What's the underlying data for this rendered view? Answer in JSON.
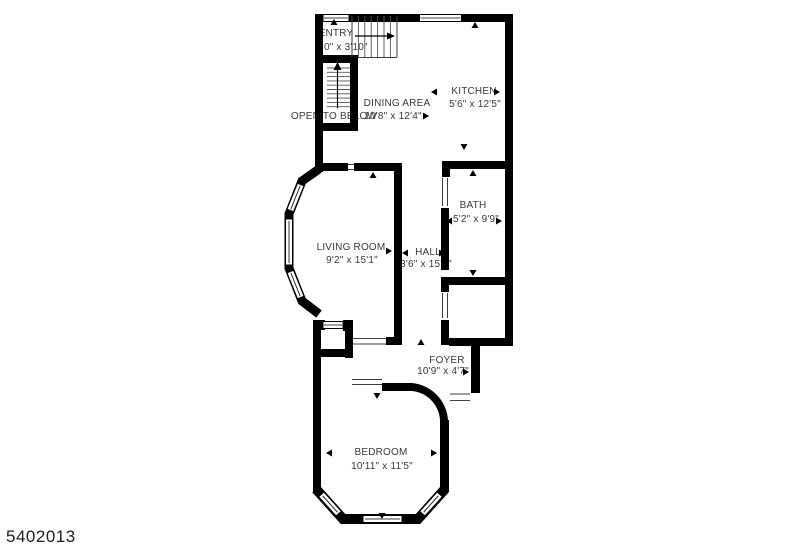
{
  "plan": {
    "watermark": "5402013",
    "rooms": [
      {
        "name": "ENTRY",
        "dims": "0\" x 3'10\""
      },
      {
        "name": "KITCHEN",
        "dims": "5'6\" x 12'5\""
      },
      {
        "name": "DINING AREA",
        "dims": "10'8\" x 12'4\""
      },
      {
        "name": "OPEN TO BELOW",
        "dims": ""
      },
      {
        "name": "LIVING ROOM",
        "dims": "9'2\" x 15'1\""
      },
      {
        "name": "HALL",
        "dims": "3'6\" x 15'1\""
      },
      {
        "name": "BATH",
        "dims": "5'2\" x 9'9\""
      },
      {
        "name": "FOYER",
        "dims": "10'9\" x 4'7\""
      },
      {
        "name": "BEDROOM",
        "dims": "10'11\" x 11'5\""
      }
    ],
    "colors": {
      "wall": "#000000",
      "label": "#3a3a3a",
      "background": "#ffffff"
    }
  }
}
